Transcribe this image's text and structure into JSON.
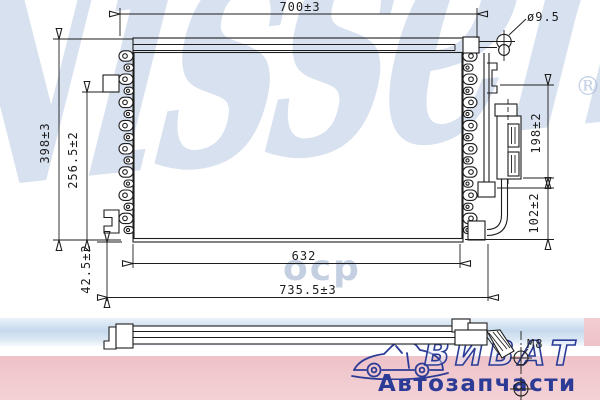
{
  "dims": {
    "top_width": "700±3",
    "port_diameter": "ø9.5",
    "overall_height": "398±3",
    "left_partial_height": "256.5±2",
    "right_upper_height": "198±2",
    "right_lower_height": "102±2",
    "bottom_bracket_offset": "42.5±2",
    "core_width": "632",
    "overall_width": "735.5±3",
    "thread_size": "M8"
  },
  "watermark": {
    "brand": "Nissens",
    "registered_mark": "®",
    "fragment": "оср"
  },
  "logo": {
    "brand": "ВИВАТ",
    "tagline": "Автозапчасти"
  },
  "colors": {
    "line": "#1d1d1d",
    "watermark_blue": "rgba(148,172,210,0.36)",
    "band_blue": "#c9dbee",
    "band_pink": "#eec2c8",
    "logo_blue": "#2b3b96"
  }
}
